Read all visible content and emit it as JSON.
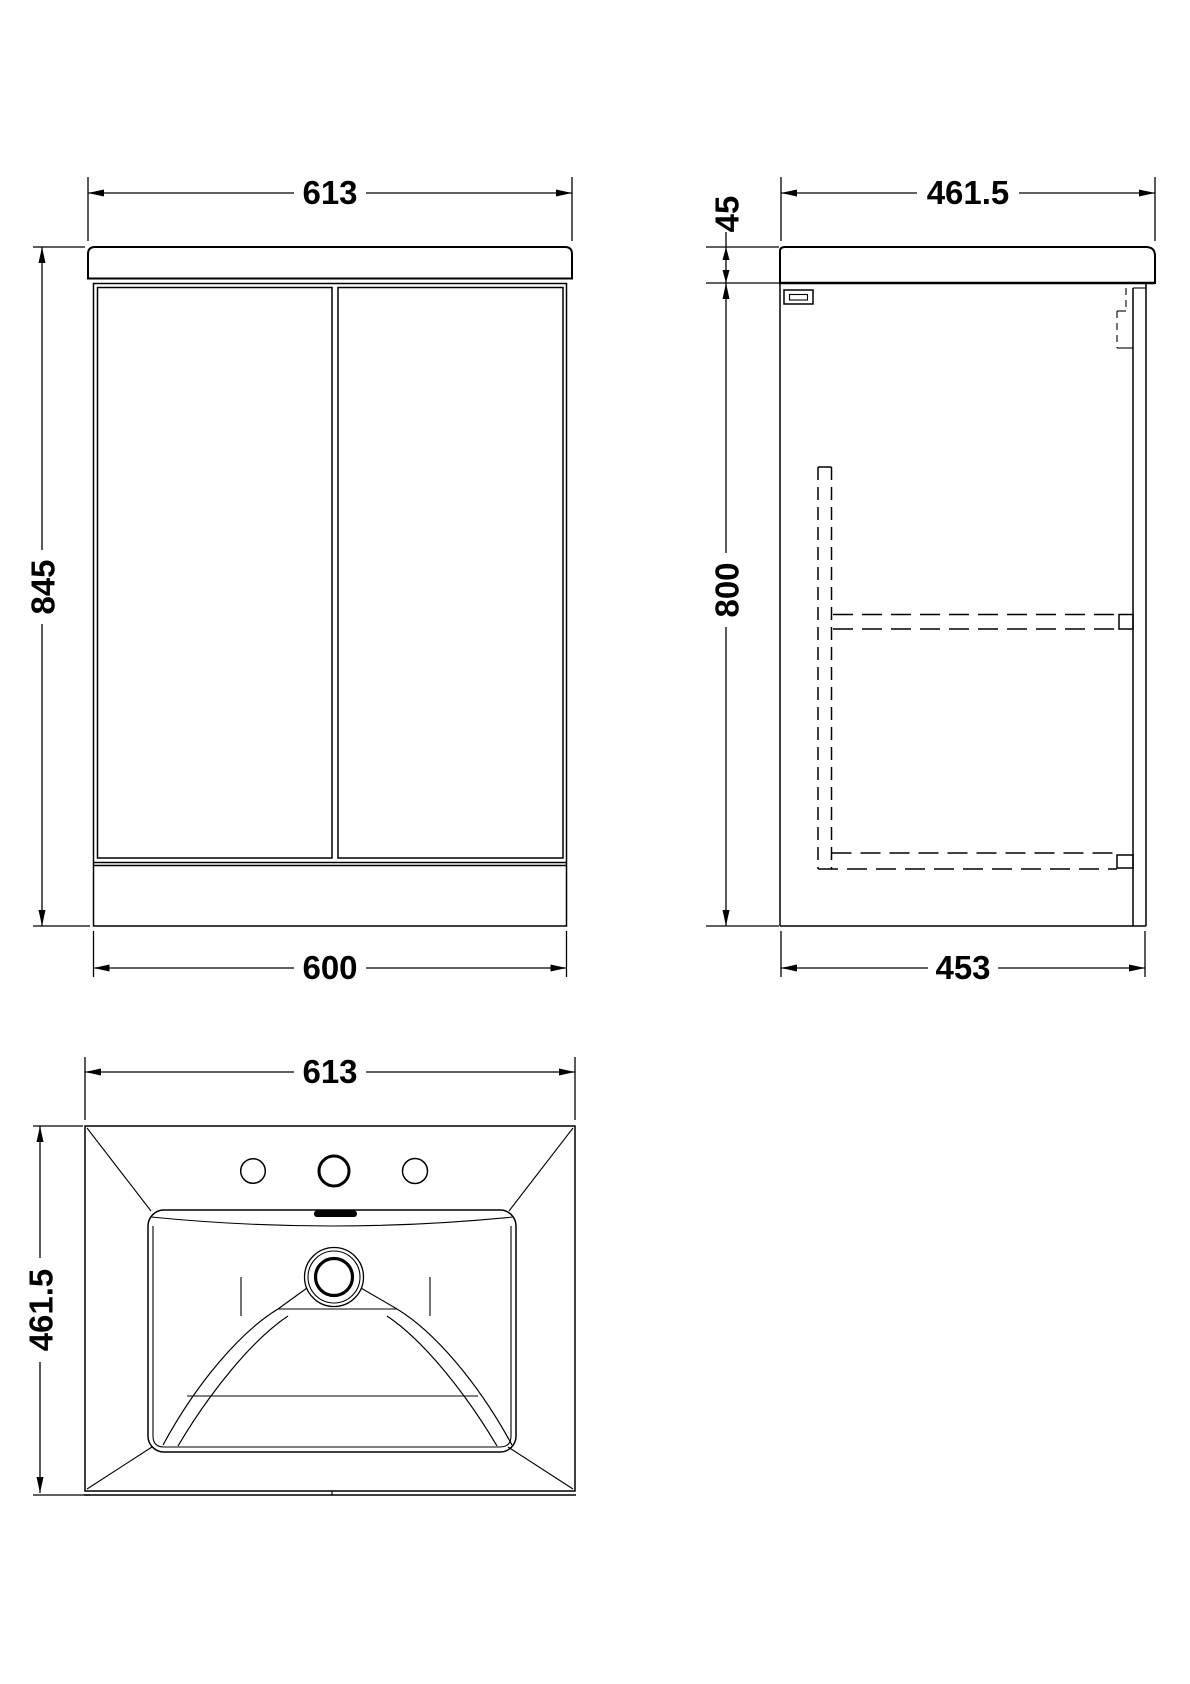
{
  "drawing": {
    "colors": {
      "line": "#000000",
      "background": "#ffffff"
    },
    "views": {
      "front": {
        "dims": {
          "top_width": "613",
          "height": "845",
          "bottom_width": "600"
        }
      },
      "side": {
        "dims": {
          "top_depth": "461.5",
          "worktop_thickness": "45",
          "cabinet_height": "800",
          "bottom_depth": "453"
        }
      },
      "basin": {
        "dims": {
          "width": "613",
          "depth": "461.5"
        }
      }
    }
  }
}
